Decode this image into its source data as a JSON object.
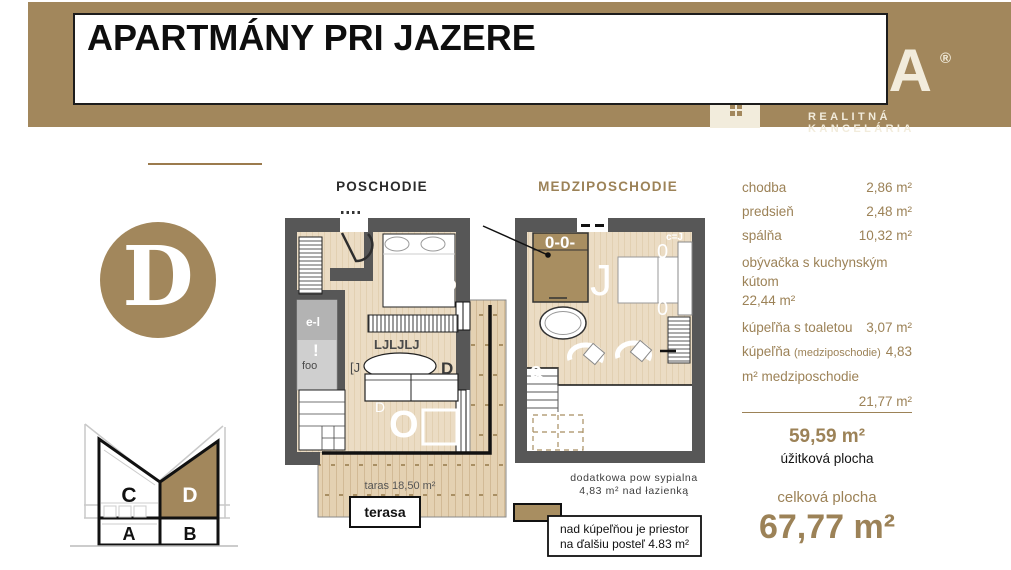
{
  "header": {
    "title": "APARTMÁNY PRI JAZERE",
    "logo_word": "MEGA",
    "logo_reg": "®",
    "logo_tagline": "REALITNÁ KANCELÁRIA"
  },
  "badge": {
    "letter": "D"
  },
  "plans": {
    "poschodie": {
      "title": "POSCHODIE",
      "terrace_text": "taras 18,50 m²",
      "terrace_label": "terasa",
      "glyph_ljl": "LJLJLJ",
      "glyph_bracket_j": "[J",
      "glyph_d_table": "D",
      "glyph_foo": "foo",
      "glyph_el": "e-l",
      "glyph_excl": "!",
      "glyph_o": "O",
      "glyph_d_small": "D",
      "glyph_d_wall": "D"
    },
    "medziposchodie": {
      "title": "MEDZIPOSCHODIE",
      "glyph_ooo": "0-0-",
      "glyph_j": "J",
      "glyph_a": "a",
      "glyph_cj": "c=J",
      "glyph_zero_top": "0",
      "glyph_zero_bottom": "0",
      "note_line1": "dodatkowa pow sypialna",
      "note_line2": "4,83 m² nad łazienką",
      "box_line1": "nad kúpeľňou je priestor",
      "box_line2": "na ďalšiu posteľ 4.83 m²"
    }
  },
  "building": {
    "c": "C",
    "d": "D",
    "a": "A",
    "b": "B"
  },
  "areas": {
    "row1_label": "chodba",
    "row1_value": "2,86 m²",
    "row2_label": "predsieň",
    "row2_value": "2,48 m²",
    "row3_label": "spálňa",
    "row3_value": "10,32 m²",
    "row4_label": "obývačka s kuchynským kútom",
    "row4_value": "22,44 m²",
    "row5_label": "kúpeľňa s toaletou",
    "row5_value": "3,07 m²",
    "row6_label": "kúpeľňa",
    "row6_paren": "(medziposchodie)",
    "row6_value": "4,83",
    "row7_label": "m² medziposchodie",
    "row8_value": "21,77 m²",
    "usable_value": "59,59 m²",
    "usable_caption": "úžitková plocha",
    "total_caption": "celková plocha",
    "total_value": "67,77 m²"
  },
  "colors": {
    "brand_brown": "#A2875C",
    "text_brown": "#9C8257",
    "wall_gray": "#575757",
    "wood_floor": "#ECDFC9",
    "deck_wood": "#E6D4B6",
    "accent_furniture": "#A88E61"
  }
}
